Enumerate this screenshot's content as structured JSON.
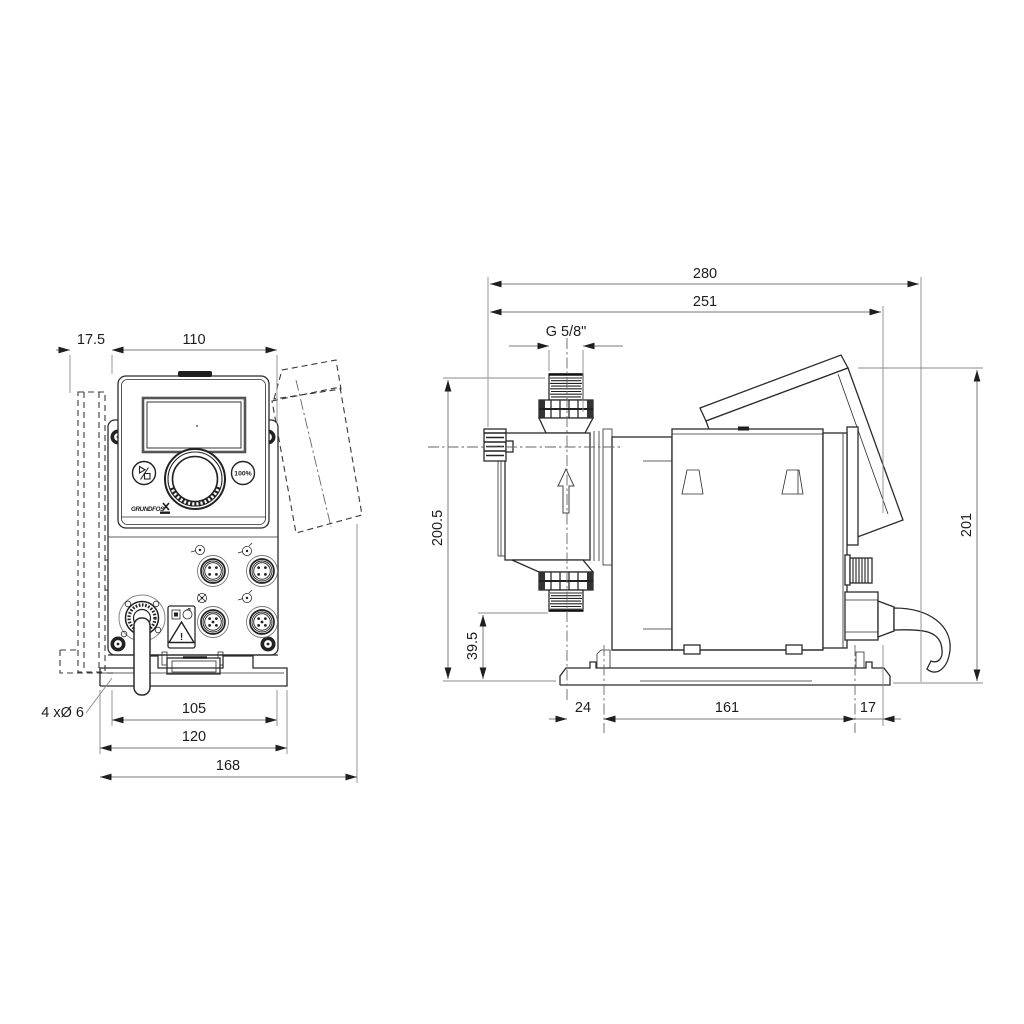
{
  "drawing": {
    "front_view": {
      "dims": {
        "offset": "17.5",
        "width": "110",
        "hole_spacing": "105",
        "plate_width": "120",
        "total_width": "168",
        "hole_note": "4 xØ 6"
      },
      "panel": {
        "percent_button": "100%",
        "brand": "GRUNDFOS",
        "warning_mark": "!"
      }
    },
    "side_view": {
      "dims": {
        "total_depth": "280",
        "depth_to_cube": "251",
        "thread": "G 5/8\"",
        "height": "200.5",
        "inlet_height": "39.5",
        "front_offset": "24",
        "base_hole_spacing": "161",
        "rear_offset": "17",
        "rear_height": "201"
      }
    }
  }
}
